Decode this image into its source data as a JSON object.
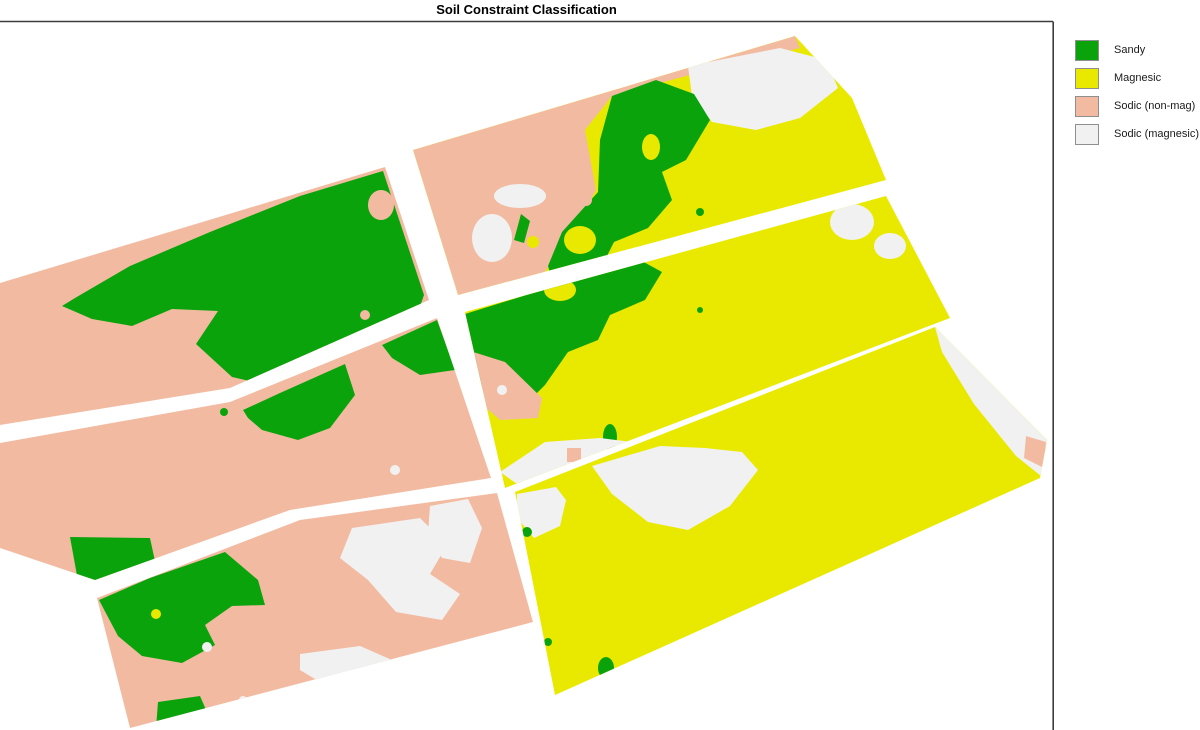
{
  "title": "Soil Constraint Classification",
  "frame": {
    "color": "#3d3d3d"
  },
  "classes": {
    "sandy": {
      "label": "Sandy",
      "color": "#0ba30b"
    },
    "magnesic": {
      "label": "Magnesic",
      "color": "#e9e900"
    },
    "sodic_nonmag": {
      "label": "Sodic (non-mag)",
      "color": "#f2bba1"
    },
    "sodic_mag": {
      "label": "Sodic (magnesic)",
      "color": "#f1f1f1"
    }
  },
  "legend": {
    "items": [
      {
        "class": "sandy"
      },
      {
        "class": "magnesic"
      },
      {
        "class": "sodic_nonmag"
      },
      {
        "class": "sodic_mag"
      }
    ]
  },
  "map": {
    "paddocks": [
      {
        "id": "left-top",
        "class": "sodic_nonmag",
        "points": "0,283 385,167 429,300 230,388 0,425"
      },
      {
        "id": "left-middle",
        "class": "sodic_nonmag",
        "points": "0,443 230,402 437,318 491,478 290,510 95,580 0,548"
      },
      {
        "id": "left-bottom",
        "class": "sodic_nonmag",
        "points": "97,598 300,520 497,493 533,622 130,728"
      },
      {
        "id": "right-top",
        "class": "magnesic",
        "points": "413,150 795,36 852,98 886,180 458,295"
      },
      {
        "id": "right-middle",
        "class": "magnesic",
        "points": "465,312 886,196 950,318 505,488"
      },
      {
        "id": "right-bottom",
        "class": "magnesic",
        "points": "515,492 935,327 1047,440 1040,478 555,695"
      }
    ],
    "features": [
      {
        "p": "left-top",
        "c": "sandy",
        "poly": "383,171 300,196 210,232 130,266 75,298 62,306 92,319 132,326 172,309 218,311 196,344 232,377 298,392 356,396 404,352 424,295"
      },
      {
        "p": "left-top",
        "c": "sodic_nonmag",
        "e": [
          381,
          205,
          13,
          15
        ]
      },
      {
        "p": "left-top",
        "c": "sodic_nonmag",
        "e": [
          365,
          315,
          5,
          5
        ]
      },
      {
        "p": "left-top",
        "c": "magnesic",
        "e": [
          290,
          368,
          9,
          5
        ]
      },
      {
        "p": "left-middle",
        "c": "sandy",
        "poly": "243,410 280,393 345,364 355,395 330,428 298,440 262,430 248,418"
      },
      {
        "p": "left-middle",
        "c": "sandy",
        "poly": "382,345 437,320 455,370 420,375 392,358"
      },
      {
        "p": "left-middle",
        "c": "sandy",
        "poly": "70,537 150,538 158,575 122,600 80,592"
      },
      {
        "p": "left-middle",
        "c": "sandy",
        "e": [
          224,
          412,
          4,
          4
        ]
      },
      {
        "p": "left-middle",
        "c": "sodic_mag",
        "e": [
          395,
          470,
          5,
          5
        ]
      },
      {
        "p": "left-bottom",
        "c": "sandy",
        "poly": "99,600 150,578 225,552 258,580 265,605 232,606 205,625 215,645 182,663 142,656 118,636"
      },
      {
        "p": "left-bottom",
        "c": "magnesic",
        "e": [
          156,
          614,
          5,
          5
        ]
      },
      {
        "p": "left-bottom",
        "c": "sandy",
        "poly": "158,702 200,696 214,728 156,728"
      },
      {
        "p": "left-bottom",
        "c": "sodic_mag",
        "poly": "352,528 420,518 447,545 430,574 460,594 442,620 396,612 368,580 340,558"
      },
      {
        "p": "left-bottom",
        "c": "sodic_mag",
        "poly": "300,654 360,646 392,660 380,686 330,688 300,670"
      },
      {
        "p": "left-bottom",
        "c": "sodic_mag",
        "poly": "430,506 468,499 482,528 470,563 442,558 428,534"
      },
      {
        "p": "left-bottom",
        "c": "sodic_mag",
        "e": [
          207,
          647,
          5,
          5
        ]
      },
      {
        "p": "left-bottom",
        "c": "sodic_mag",
        "e": [
          243,
          700,
          4,
          4
        ]
      },
      {
        "p": "right-top",
        "c": "sodic_nonmag",
        "poly": "413,150 795,36 800,48 690,75 612,96 585,130 596,190 570,240 530,290 458,295"
      },
      {
        "p": "right-top",
        "c": "sodic_mag",
        "poly": "688,66 780,48 826,60 838,88 800,118 756,130 712,122 692,96"
      },
      {
        "p": "right-top",
        "c": "sandy",
        "poly": "612,96 656,80 694,94 710,120 686,160 662,172 672,200 648,228 614,242 600,270 580,298 558,302 548,266 562,232 598,192 600,140"
      },
      {
        "p": "right-top",
        "c": "magnesic",
        "e": [
          651,
          147,
          9,
          13
        ]
      },
      {
        "p": "right-top",
        "c": "magnesic",
        "e": [
          580,
          240,
          16,
          14
        ]
      },
      {
        "p": "right-top",
        "c": "sodic_nonmag",
        "e": [
          586,
          200,
          6,
          6
        ]
      },
      {
        "p": "right-top",
        "c": "sodic_mag",
        "e": [
          520,
          196,
          26,
          12
        ]
      },
      {
        "p": "right-top",
        "c": "sodic_mag",
        "e": [
          492,
          238,
          20,
          24
        ]
      },
      {
        "p": "right-top",
        "c": "sandy",
        "poly": "514,240 521,214 530,221 524,243"
      },
      {
        "p": "right-top",
        "c": "magnesic",
        "e": [
          533,
          242,
          6,
          6
        ]
      },
      {
        "p": "right-top",
        "c": "sandy",
        "e": [
          700,
          212,
          4,
          4
        ]
      },
      {
        "p": "right-middle",
        "c": "sandy",
        "poly": "465,314 520,297 580,278 640,260 662,272 645,300 610,315 598,340 568,352 545,385 520,410 496,414 478,380 466,350"
      },
      {
        "p": "right-middle",
        "c": "magnesic",
        "e": [
          560,
          290,
          16,
          11
        ]
      },
      {
        "p": "right-middle",
        "c": "magnesic",
        "e": [
          494,
          378,
          13,
          11
        ]
      },
      {
        "p": "right-middle",
        "c": "sodic_nonmag",
        "poly": "467,350 505,362 542,398 538,418 500,420 472,396 462,368"
      },
      {
        "p": "right-middle",
        "c": "sodic_mag",
        "e": [
          502,
          390,
          5,
          5
        ]
      },
      {
        "p": "right-middle",
        "c": "sandy",
        "e": [
          610,
          437,
          7,
          13
        ]
      },
      {
        "p": "right-middle",
        "c": "sodic_mag",
        "poly": "500,472 545,442 600,438 640,443 622,464 562,477 520,486"
      },
      {
        "p": "right-middle",
        "c": "sodic_nonmag",
        "poly": "567,448 581,448 581,462 567,462"
      },
      {
        "p": "right-middle",
        "c": "sandy",
        "e": [
          700,
          310,
          3,
          3
        ]
      },
      {
        "p": "right-middle",
        "c": "sodic_mag",
        "e": [
          852,
          222,
          22,
          18
        ]
      },
      {
        "p": "right-middle",
        "c": "sodic_mag",
        "e": [
          890,
          246,
          16,
          13
        ]
      },
      {
        "p": "right-bottom",
        "c": "sodic_mag",
        "poly": "935,327 1047,440 1041,476 1016,456 974,404 942,352"
      },
      {
        "p": "right-bottom",
        "c": "sodic_nonmag",
        "e": [
          1012,
          376,
          11,
          9
        ]
      },
      {
        "p": "right-bottom",
        "c": "sodic_nonmag",
        "poly": "1026,436 1046,442 1044,468 1024,458"
      },
      {
        "p": "right-bottom",
        "c": "sodic_mag",
        "poly": "592,466 660,446 705,448 742,452 758,470 730,506 688,530 648,522 612,494"
      },
      {
        "p": "right-bottom",
        "c": "sodic_mag",
        "poly": "517,494 556,487 566,500 560,526 534,538 517,518"
      },
      {
        "p": "right-bottom",
        "c": "sandy",
        "e": [
          606,
          668,
          8,
          11
        ]
      },
      {
        "p": "right-bottom",
        "c": "sandy",
        "e": [
          548,
          642,
          4,
          4
        ]
      },
      {
        "p": "right-bottom",
        "c": "sandy",
        "e": [
          527,
          532,
          5,
          5
        ]
      }
    ]
  }
}
